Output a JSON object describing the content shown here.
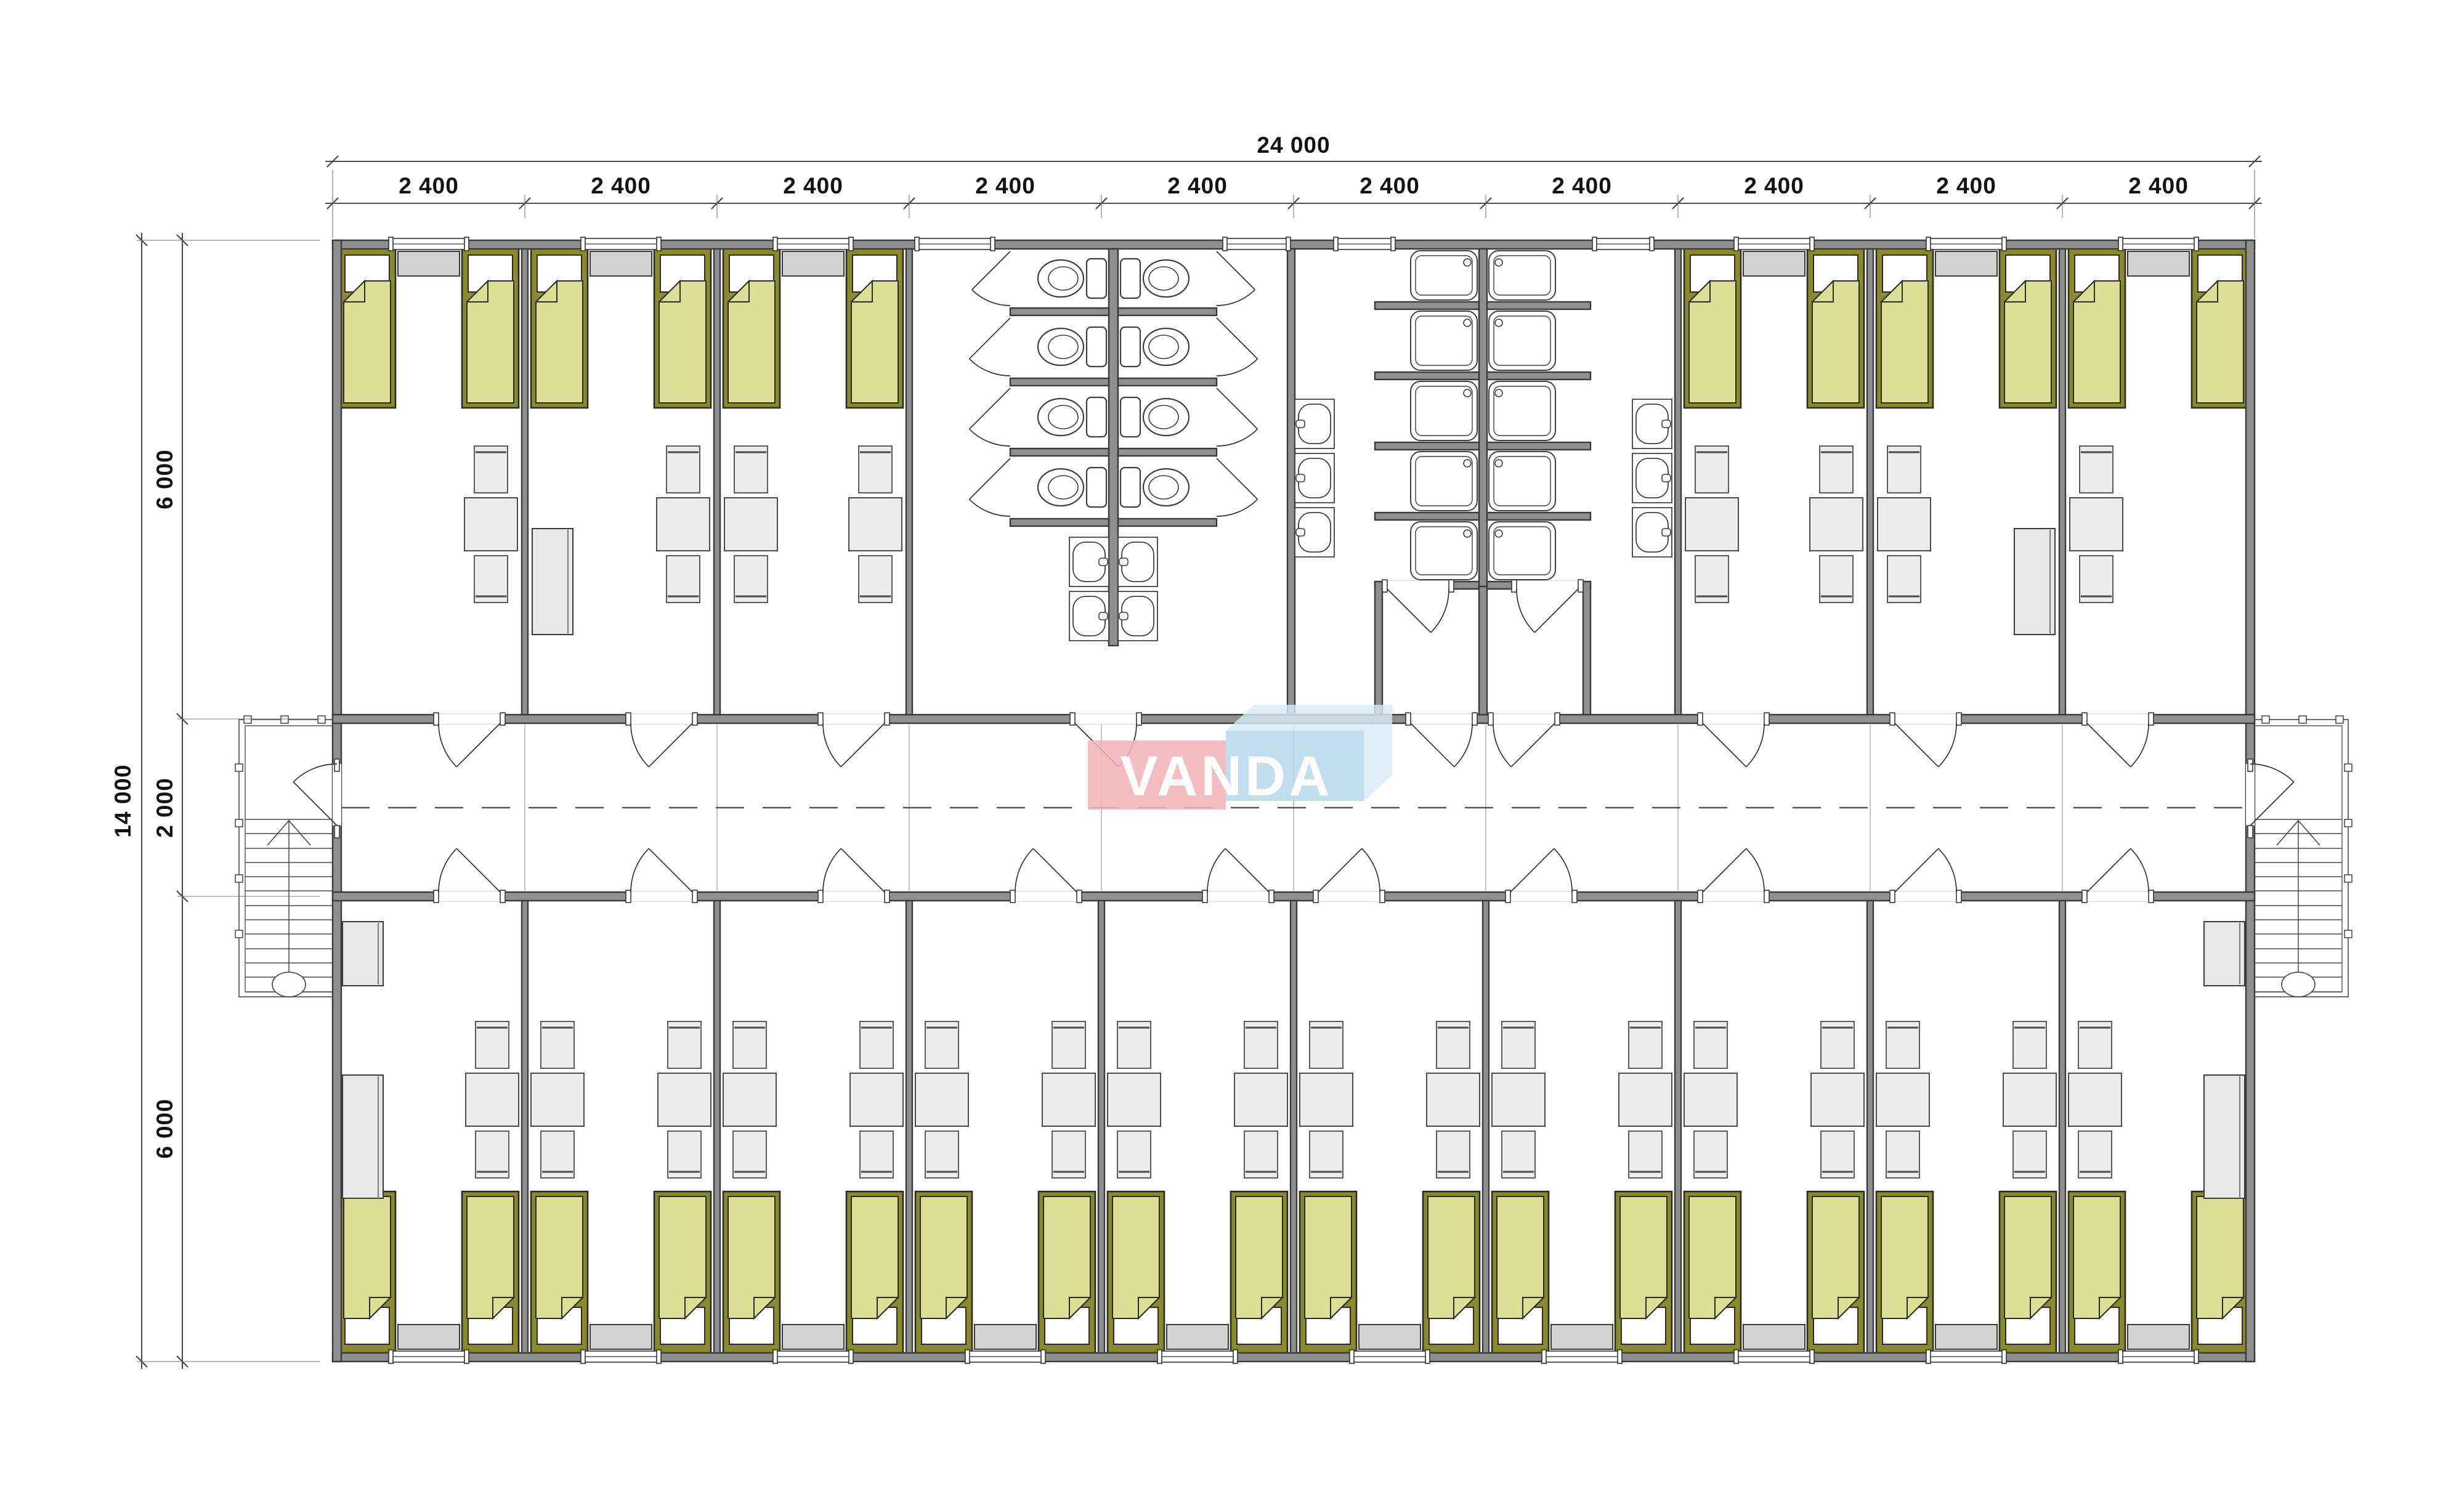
{
  "document": {
    "type": "architectural floor plan",
    "units": "mm"
  },
  "logo": {
    "text": "VANDA",
    "pink": "#f3b4ba",
    "blue": "#b9d8ea",
    "blue_light": "#d8ebf7",
    "text_color": "#ffffff"
  },
  "dimensions": {
    "overall_width": "24 000",
    "bay_width": "2 400",
    "bay_count": 10,
    "overall_depth": "14 000",
    "top_wing_depth": "6 000",
    "corridor_depth": "2 000",
    "bottom_wing_depth": "6 000"
  },
  "palette": {
    "wall_fill": "#8f8f8f",
    "wall_stroke": "#3a3a3a",
    "line": "#3f3f3f",
    "thin_line": "#666666",
    "bed_frame": "#8a8a2c",
    "bed_blanket": "#dedf96",
    "pillow": "#ffffff",
    "furniture_fill": "#ececec",
    "furniture_stroke": "#4a4a4a",
    "radiator_fill": "#d2d2d2",
    "wardrobe_fill": "#e8e8e8",
    "corridor_line": "#b5b5b5",
    "dim_text": "#111111",
    "background": "#ffffff"
  },
  "inventory": {
    "bedrooms": 16,
    "beds": 32,
    "toilets": 8,
    "showers": 10,
    "wash_basins": 10,
    "tables": 26,
    "chairs": 52,
    "wardrobes": 6,
    "radiators": 16,
    "windows": 20,
    "staircases": 2
  }
}
